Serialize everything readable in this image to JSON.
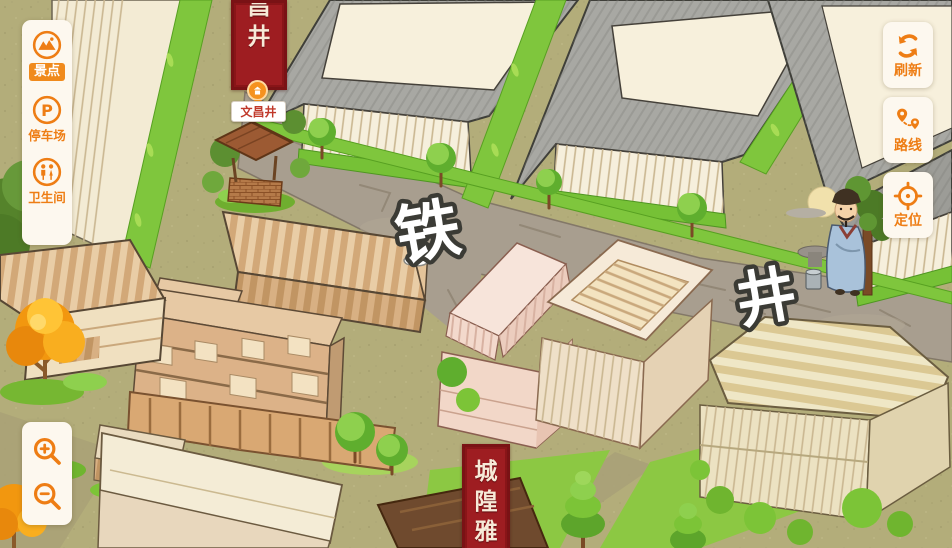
{
  "map": {
    "road_labels": [
      {
        "char": "铁"
      },
      {
        "char": "井"
      }
    ],
    "poi_well": {
      "label": "文昌井"
    },
    "banner_top": {
      "chars": [
        "昌",
        "井"
      ]
    },
    "banner_bottom": {
      "chars": [
        "城",
        "隍",
        "雅"
      ]
    }
  },
  "sidebar_left": {
    "items": [
      {
        "id": "scenic",
        "label": "景点",
        "icon": "scenic-spot-icon",
        "active": true
      },
      {
        "id": "parking",
        "label": "停车场",
        "icon": "parking-icon",
        "active": false
      },
      {
        "id": "toilet",
        "label": "卫生间",
        "icon": "restroom-icon",
        "active": false
      }
    ]
  },
  "sidebar_right": {
    "items": [
      {
        "id": "refresh",
        "label": "刷新",
        "icon": "refresh-icon"
      },
      {
        "id": "route",
        "label": "路线",
        "icon": "route-icon"
      },
      {
        "id": "locate",
        "label": "定位",
        "icon": "locate-icon"
      }
    ]
  },
  "zoom_controls": {
    "items": [
      {
        "id": "zoom-in",
        "icon": "zoom-in-icon"
      },
      {
        "id": "zoom-out",
        "icon": "zoom-out-icon"
      }
    ]
  },
  "colors": {
    "accent_orange": "#ee7d14",
    "active_pill": "#f08a1c",
    "banner_red": "#9e1d21",
    "poi_text_red": "#c0392b",
    "road_gray": "#a89e8f",
    "ground_khaki": "#b3ad7a",
    "grass_green": "#7fc63d"
  }
}
